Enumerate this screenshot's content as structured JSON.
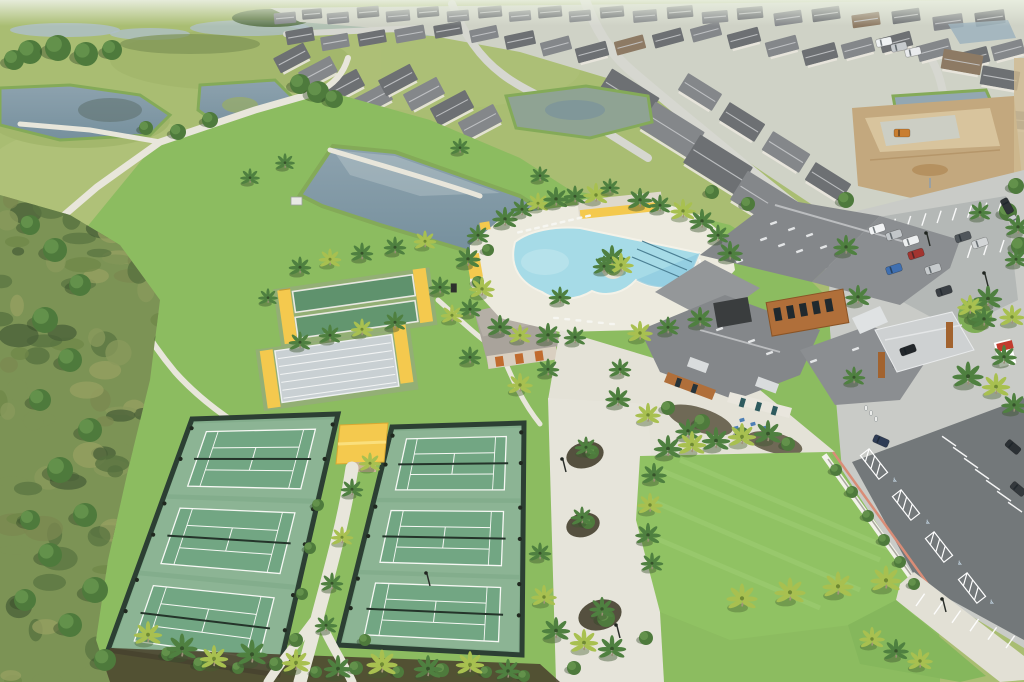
{
  "scene_title": "aerial-view-community-amenity-center",
  "palette": {
    "haze": "#e7ecdd",
    "meadow": "#a9bd72",
    "meadowLight": "#bcc985",
    "scrub": "#7c9355",
    "scrubDark": "#5a7442",
    "scrubBrown": "#94915f",
    "water": "#93a7b2",
    "waterDark": "#76909d",
    "waterLight": "#b3c2c8",
    "pondEdge": "#84aa58",
    "marsh": "#8fa393",
    "brightGrass": "#8cbc60",
    "lawn": "#90c263",
    "lawnStripe": "#9ccb70",
    "path": "#e8e6db",
    "concrete": "#e4e2d7",
    "streets": "#d6d7d0",
    "housingBase": "#cfd2c6",
    "courtBase": "#83ad8c",
    "courtPad": "#8cb494",
    "courtGreen": "#72a683",
    "courtLine": "#f6f8f4",
    "fence": "#2c3f33",
    "net": "#24342a",
    "canopy": "#f4c94e",
    "canopyLight": "#fadf7c",
    "bocceGreen": "#5f926d",
    "shuffleGray": "#c9d0d3",
    "roofDark": "#6d7073",
    "roofMid": "#84878a",
    "roofBrown": "#8d7a64",
    "roofLight": "#9aa0a2",
    "ridge": "#c9cbcd",
    "wood": "#b06f3a",
    "woodDark": "#8a5426",
    "wall": "#e9e6dd",
    "poolWater": "#a6dbe7",
    "poolDeep": "#8ecadf",
    "laneLine": "#4b7f93",
    "poolDeck": "#eceade",
    "asphaltLight": "#c9cbc7",
    "asphaltDark": "#73787a",
    "stall": "#ffffff",
    "curbRed": "#d98d77",
    "whiteWall": "#f3f2ea",
    "mulch": "#4b452f",
    "dirt": "#c3a87e",
    "dirtLight": "#d8c49d",
    "trunk": "#9b8f78",
    "palmGreen": "#4f8040",
    "palmYellow": "#a8c050",
    "signRed": "#c23b2e",
    "teal": "#2e5a5e"
  },
  "icons": {
    "accessible_parking": "♿"
  },
  "landmarks": {
    "courts_left_label": "tennis-pickleball-courts-west",
    "courts_right_label": "tennis-pickleball-courts-east",
    "pool_label": "resort-pool",
    "clubhouse_label": "clubhouse",
    "lawn_label": "event-lawn",
    "pond_label": "retention-pond"
  },
  "houses": [
    [
      285,
      18,
      22,
      11,
      -5,
      1
    ],
    [
      312,
      14,
      20,
      10,
      -5,
      0
    ],
    [
      338,
      18,
      22,
      11,
      -5,
      1
    ],
    [
      368,
      12,
      22,
      11,
      -5,
      0
    ],
    [
      398,
      16,
      24,
      11,
      -5,
      1
    ],
    [
      428,
      12,
      22,
      10,
      -5,
      0
    ],
    [
      458,
      16,
      22,
      11,
      -5,
      1
    ],
    [
      490,
      12,
      24,
      11,
      -5,
      0
    ],
    [
      520,
      16,
      22,
      10,
      -5,
      1
    ],
    [
      550,
      12,
      24,
      11,
      -5,
      0
    ],
    [
      580,
      16,
      22,
      11,
      -5,
      1
    ],
    [
      612,
      12,
      24,
      11,
      -5,
      0
    ],
    [
      645,
      16,
      24,
      12,
      -5,
      1
    ],
    [
      680,
      12,
      26,
      12,
      -5,
      0
    ],
    [
      715,
      17,
      26,
      12,
      -5,
      1
    ],
    [
      750,
      13,
      26,
      12,
      -5,
      0
    ],
    [
      788,
      18,
      28,
      13,
      -8,
      1
    ],
    [
      826,
      14,
      28,
      13,
      -8,
      0
    ],
    [
      866,
      20,
      28,
      13,
      -8,
      2
    ],
    [
      906,
      16,
      28,
      13,
      -8,
      0
    ],
    [
      948,
      22,
      30,
      14,
      -8,
      1
    ],
    [
      990,
      18,
      30,
      14,
      -8,
      0
    ],
    [
      300,
      36,
      28,
      14,
      -10,
      0
    ],
    [
      335,
      42,
      28,
      14,
      -10,
      1
    ],
    [
      372,
      38,
      28,
      13,
      -10,
      0
    ],
    [
      410,
      34,
      30,
      14,
      -10,
      1
    ],
    [
      448,
      30,
      28,
      13,
      -10,
      0
    ],
    [
      484,
      34,
      28,
      13,
      -12,
      1
    ],
    [
      520,
      40,
      30,
      14,
      -12,
      0
    ],
    [
      556,
      46,
      30,
      14,
      -15,
      1
    ],
    [
      592,
      52,
      32,
      15,
      -15,
      0
    ],
    [
      630,
      45,
      30,
      14,
      -15,
      2
    ],
    [
      668,
      38,
      30,
      14,
      -15,
      0
    ],
    [
      706,
      32,
      30,
      14,
      -15,
      1
    ],
    [
      744,
      38,
      32,
      15,
      -15,
      0
    ],
    [
      782,
      46,
      32,
      15,
      -15,
      1
    ],
    [
      820,
      54,
      34,
      16,
      -15,
      0
    ],
    [
      858,
      48,
      32,
      15,
      -15,
      1
    ],
    [
      896,
      42,
      32,
      15,
      -15,
      0
    ],
    [
      934,
      50,
      34,
      16,
      -15,
      1
    ],
    [
      972,
      58,
      34,
      16,
      -15,
      0
    ],
    [
      1008,
      50,
      32,
      15,
      -15,
      1
    ],
    [
      292,
      58,
      34,
      17,
      -28,
      0
    ],
    [
      318,
      72,
      36,
      18,
      -28,
      1
    ],
    [
      344,
      86,
      38,
      19,
      -28,
      0
    ],
    [
      372,
      100,
      38,
      19,
      -28,
      1
    ],
    [
      398,
      80,
      36,
      18,
      -28,
      0
    ],
    [
      424,
      94,
      38,
      19,
      -28,
      1
    ],
    [
      452,
      108,
      40,
      20,
      -28,
      0
    ],
    [
      480,
      122,
      40,
      20,
      -28,
      1
    ],
    [
      628,
      96,
      56,
      30,
      32,
      0
    ],
    [
      672,
      130,
      58,
      31,
      32,
      1
    ],
    [
      718,
      165,
      62,
      33,
      32,
      0
    ],
    [
      766,
      202,
      64,
      34,
      32,
      1
    ],
    [
      814,
      240,
      64,
      34,
      32,
      0
    ],
    [
      700,
      92,
      40,
      20,
      32,
      1
    ],
    [
      742,
      122,
      42,
      21,
      32,
      0
    ],
    [
      786,
      152,
      44,
      22,
      32,
      1
    ],
    [
      828,
      182,
      42,
      21,
      32,
      0
    ],
    [
      962,
      62,
      40,
      20,
      10,
      2
    ],
    [
      1000,
      78,
      38,
      19,
      10,
      0
    ],
    [
      1016,
      120,
      34,
      18,
      5,
      1
    ]
  ],
  "palms": [
    [
      505,
      222,
      0.9,
      0
    ],
    [
      522,
      212,
      0.8,
      0
    ],
    [
      538,
      206,
      0.8,
      1
    ],
    [
      556,
      202,
      0.9,
      0
    ],
    [
      575,
      199,
      0.8,
      0
    ],
    [
      596,
      198,
      0.9,
      1
    ],
    [
      640,
      203,
      0.9,
      0
    ],
    [
      660,
      208,
      0.8,
      0
    ],
    [
      683,
      214,
      0.9,
      1
    ],
    [
      702,
      224,
      0.9,
      0
    ],
    [
      718,
      238,
      0.8,
      0
    ],
    [
      730,
      256,
      0.9,
      0
    ],
    [
      612,
      262,
      1.0,
      0
    ],
    [
      621,
      268,
      0.9,
      1
    ],
    [
      604,
      269,
      0.8,
      0
    ],
    [
      478,
      238,
      0.8,
      0
    ],
    [
      468,
      262,
      0.9,
      0
    ],
    [
      482,
      292,
      0.9,
      1
    ],
    [
      470,
      312,
      0.8,
      0
    ],
    [
      500,
      330,
      0.9,
      0
    ],
    [
      520,
      338,
      0.8,
      1
    ],
    [
      548,
      338,
      0.9,
      0
    ],
    [
      575,
      340,
      0.8,
      0
    ],
    [
      640,
      336,
      0.9,
      1
    ],
    [
      668,
      330,
      0.8,
      0
    ],
    [
      700,
      322,
      0.9,
      0
    ],
    [
      300,
      270,
      0.8,
      0
    ],
    [
      330,
      262,
      0.8,
      1
    ],
    [
      362,
      256,
      0.8,
      0
    ],
    [
      395,
      250,
      0.8,
      0
    ],
    [
      425,
      244,
      0.8,
      1
    ],
    [
      300,
      345,
      0.8,
      0
    ],
    [
      330,
      338,
      0.8,
      0
    ],
    [
      362,
      332,
      0.8,
      1
    ],
    [
      395,
      325,
      0.8,
      0
    ],
    [
      268,
      300,
      0.7,
      0
    ],
    [
      440,
      290,
      0.8,
      0
    ],
    [
      452,
      318,
      0.8,
      1
    ],
    [
      470,
      360,
      0.8,
      0
    ],
    [
      520,
      388,
      0.9,
      1
    ],
    [
      548,
      372,
      0.8,
      0
    ],
    [
      560,
      300,
      0.8,
      0
    ],
    [
      618,
      402,
      0.9,
      0
    ],
    [
      648,
      418,
      0.9,
      1
    ],
    [
      688,
      434,
      0.9,
      0
    ],
    [
      620,
      372,
      0.8,
      0
    ],
    [
      668,
      452,
      1.0,
      0
    ],
    [
      692,
      448,
      1.0,
      1
    ],
    [
      716,
      444,
      1.0,
      0
    ],
    [
      742,
      440,
      1.0,
      1
    ],
    [
      768,
      437,
      1.0,
      0
    ],
    [
      654,
      478,
      0.9,
      0
    ],
    [
      650,
      508,
      0.9,
      1
    ],
    [
      648,
      538,
      0.9,
      0
    ],
    [
      652,
      566,
      0.8,
      0
    ],
    [
      742,
      602,
      1.1,
      1
    ],
    [
      790,
      596,
      1.1,
      1
    ],
    [
      838,
      590,
      1.1,
      1
    ],
    [
      886,
      584,
      1.1,
      1
    ],
    [
      858,
      300,
      0.9,
      0
    ],
    [
      988,
      302,
      1.0,
      0
    ],
    [
      1012,
      320,
      0.9,
      1
    ],
    [
      968,
      380,
      1.1,
      0
    ],
    [
      996,
      390,
      1.0,
      1
    ],
    [
      1014,
      408,
      0.9,
      0
    ],
    [
      854,
      380,
      0.8,
      0
    ],
    [
      846,
      250,
      0.9,
      0
    ],
    [
      980,
      215,
      0.8,
      0
    ],
    [
      1018,
      230,
      0.9,
      0
    ],
    [
      970,
      310,
      0.9,
      1
    ],
    [
      984,
      322,
      0.9,
      0
    ],
    [
      1016,
      262,
      0.8,
      0
    ],
    [
      1004,
      360,
      0.9,
      0
    ],
    [
      148,
      638,
      1.0,
      1
    ],
    [
      182,
      652,
      1.1,
      0
    ],
    [
      214,
      662,
      1.0,
      1
    ],
    [
      252,
      658,
      1.1,
      0
    ],
    [
      296,
      666,
      1.0,
      1
    ],
    [
      338,
      672,
      1.0,
      0
    ],
    [
      382,
      668,
      1.1,
      1
    ],
    [
      428,
      672,
      1.0,
      0
    ],
    [
      470,
      668,
      1.0,
      1
    ],
    [
      508,
      674,
      0.9,
      0
    ],
    [
      352,
      492,
      0.8,
      0
    ],
    [
      342,
      540,
      0.8,
      1
    ],
    [
      332,
      586,
      0.8,
      0
    ],
    [
      326,
      628,
      0.8,
      0
    ],
    [
      370,
      466,
      0.8,
      1
    ],
    [
      540,
      556,
      0.8,
      0
    ],
    [
      544,
      600,
      0.9,
      1
    ],
    [
      556,
      634,
      1.0,
      0
    ],
    [
      584,
      646,
      1.0,
      1
    ],
    [
      612,
      652,
      1.0,
      0
    ],
    [
      586,
      450,
      0.8,
      0
    ],
    [
      582,
      520,
      0.8,
      0
    ],
    [
      602,
      612,
      0.9,
      0
    ],
    [
      872,
      642,
      0.9,
      1
    ],
    [
      896,
      654,
      0.9,
      0
    ],
    [
      920,
      664,
      0.9,
      1
    ],
    [
      250,
      180,
      0.7,
      0
    ],
    [
      285,
      165,
      0.7,
      0
    ],
    [
      460,
      150,
      0.7,
      0
    ],
    [
      540,
      178,
      0.7,
      0
    ],
    [
      610,
      190,
      0.7,
      0
    ]
  ],
  "bushes": [
    [
      30,
      225,
      10
    ],
    [
      55,
      250,
      12
    ],
    [
      80,
      285,
      11
    ],
    [
      45,
      320,
      13
    ],
    [
      70,
      360,
      12
    ],
    [
      40,
      400,
      11
    ],
    [
      90,
      430,
      12
    ],
    [
      60,
      470,
      13
    ],
    [
      85,
      515,
      12
    ],
    [
      50,
      555,
      12
    ],
    [
      95,
      590,
      13
    ],
    [
      70,
      625,
      12
    ],
    [
      105,
      660,
      11
    ],
    [
      30,
      520,
      10
    ],
    [
      25,
      600,
      11
    ],
    [
      318,
      505,
      6
    ],
    [
      310,
      548,
      6
    ],
    [
      302,
      594,
      6
    ],
    [
      296,
      640,
      7
    ],
    [
      365,
      640,
      6
    ],
    [
      168,
      654,
      7
    ],
    [
      200,
      664,
      7
    ],
    [
      238,
      668,
      6
    ],
    [
      276,
      664,
      7
    ],
    [
      316,
      672,
      6
    ],
    [
      356,
      668,
      7
    ],
    [
      398,
      672,
      6
    ],
    [
      442,
      670,
      7
    ],
    [
      486,
      672,
      6
    ],
    [
      524,
      676,
      6
    ],
    [
      592,
      452,
      7
    ],
    [
      588,
      522,
      7
    ],
    [
      606,
      618,
      9
    ],
    [
      574,
      668,
      7
    ],
    [
      646,
      638,
      7
    ],
    [
      30,
      52,
      12
    ],
    [
      58,
      48,
      13
    ],
    [
      86,
      54,
      12
    ],
    [
      14,
      60,
      10
    ],
    [
      112,
      50,
      10
    ],
    [
      300,
      84,
      10
    ],
    [
      318,
      92,
      11
    ],
    [
      334,
      99,
      9
    ],
    [
      210,
      120,
      8
    ],
    [
      178,
      132,
      8
    ],
    [
      146,
      128,
      7
    ],
    [
      836,
      470,
      6
    ],
    [
      852,
      492,
      6
    ],
    [
      868,
      516,
      6
    ],
    [
      884,
      540,
      6
    ],
    [
      900,
      562,
      6
    ],
    [
      914,
      584,
      6
    ],
    [
      668,
      408,
      7
    ],
    [
      702,
      422,
      8
    ],
    [
      742,
      434,
      7
    ],
    [
      788,
      444,
      7
    ],
    [
      975,
      318,
      8
    ],
    [
      712,
      192,
      7
    ],
    [
      748,
      204,
      7
    ],
    [
      488,
      250,
      6
    ],
    [
      478,
      282,
      6
    ],
    [
      846,
      200,
      8
    ],
    [
      1008,
      212,
      9
    ],
    [
      1020,
      246,
      9
    ],
    [
      1016,
      186,
      8
    ]
  ],
  "cars": [
    [
      884,
      42,
      -12,
      "#eef1f2"
    ],
    [
      899,
      47,
      -12,
      "#c6cacd"
    ],
    [
      913,
      52,
      -12,
      "#e9ebed"
    ],
    [
      877,
      229,
      -18,
      "#f1f3f4"
    ],
    [
      894,
      235,
      -18,
      "#c2c6c9"
    ],
    [
      911,
      241,
      -18,
      "#edeff0"
    ],
    [
      916,
      254,
      -18,
      "#a23530"
    ],
    [
      894,
      269,
      -18,
      "#3f6fb0"
    ],
    [
      933,
      269,
      -18,
      "#c6cacc"
    ],
    [
      944,
      291,
      -18,
      "#3a3f44"
    ],
    [
      963,
      237,
      -18,
      "#50565b"
    ],
    [
      980,
      243,
      -18,
      "#d3d6d7"
    ],
    [
      1007,
      206,
      62,
      "#2f3438"
    ],
    [
      1015,
      223,
      62,
      "#caced0"
    ],
    [
      908,
      350,
      -20,
      "#23272b"
    ],
    [
      881,
      441,
      24,
      "#2e3c55"
    ],
    [
      1013,
      447,
      40,
      "#2b3034"
    ],
    [
      1018,
      489,
      40,
      "#34393d"
    ],
    [
      902,
      133,
      0,
      "#c97e30"
    ]
  ],
  "people": [
    [
      866,
      408
    ],
    [
      871,
      413
    ],
    [
      876,
      419
    ]
  ],
  "light_poles": [
    [
      430,
      586
    ],
    [
      620,
      638
    ],
    [
      946,
      612
    ],
    [
      566,
      472
    ],
    [
      930,
      246
    ],
    [
      988,
      286
    ]
  ],
  "courts": {
    "left": {
      "corners": [
        [
          192,
          419
        ],
        [
          338,
          414
        ],
        [
          278,
          675
        ],
        [
          108,
          650
        ]
      ]
    },
    "right": {
      "corners": [
        [
          392,
          427
        ],
        [
          524,
          423
        ],
        [
          522,
          655
        ],
        [
          338,
          645
        ]
      ]
    },
    "bands": [
      [
        0.02,
        0.325
      ],
      [
        0.345,
        0.655
      ],
      [
        0.675,
        0.985
      ]
    ],
    "pad_u": [
      0.02,
      0.98
    ],
    "court_u": [
      0.13,
      0.87
    ],
    "court_v_inset": 0.12
  },
  "pool": {
    "lounger_rows": [
      {
        "x1": 520,
        "y1": 232,
        "x2": 588,
        "y2": 216,
        "n": 9,
        "rot": -12
      },
      {
        "x1": 700,
        "y1": 262,
        "x2": 716,
        "y2": 296,
        "n": 5,
        "rot": 75
      },
      {
        "x1": 556,
        "y1": 318,
        "x2": 612,
        "y2": 324,
        "n": 6,
        "rot": 3
      }
    ]
  },
  "parking": {
    "stripe_rows": [
      {
        "x1": 865,
        "y1": 224,
        "x2": 1002,
        "y2": 200,
        "n": 10,
        "len": 13,
        "ang": 108
      },
      {
        "x1": 874,
        "y1": 262,
        "x2": 1004,
        "y2": 240,
        "n": 9,
        "len": 13,
        "ang": 108
      },
      {
        "x1": 956,
        "y1": 446,
        "x2": 1022,
        "y2": 512,
        "n": 7,
        "len": 17,
        "ang": 215
      },
      {
        "x1": 916,
        "y1": 606,
        "x2": 1006,
        "y2": 648,
        "n": 6,
        "len": 15,
        "ang": -55
      }
    ],
    "hatches": [
      [
        874,
        464
      ],
      [
        906,
        505
      ],
      [
        939,
        547
      ],
      [
        972,
        588
      ]
    ],
    "hatch_rot": 52,
    "accessible_marks": [
      [
        895,
        482
      ],
      [
        928,
        524
      ],
      [
        960,
        565
      ],
      [
        992,
        604
      ]
    ]
  },
  "scrub": {
    "count": 120,
    "seed": 7
  },
  "furniture_blue": [
    [
      742,
      420
    ],
    [
      753,
      424
    ],
    [
      764,
      428
    ],
    [
      736,
      428
    ]
  ]
}
